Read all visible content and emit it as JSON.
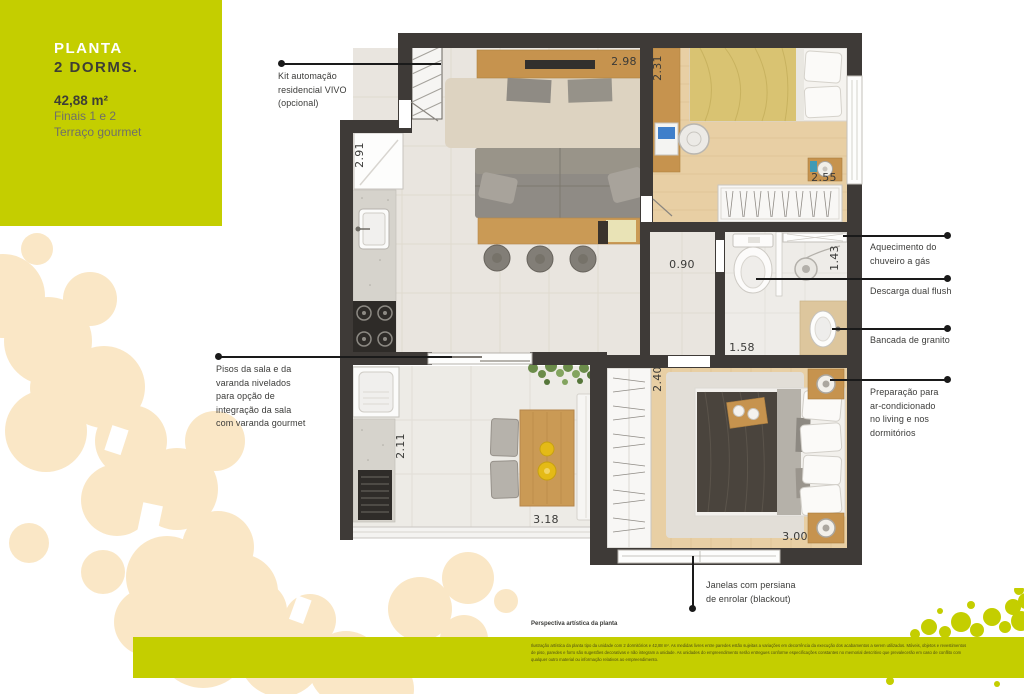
{
  "colors": {
    "accent_green": "#c4ce00",
    "cream_blob": "#fae7c6",
    "wall_dark": "#3e3a37",
    "wood": "#c6934e",
    "text_dark": "#3b3b39",
    "text_gray": "#6f6f68"
  },
  "title_block": {
    "heading_line1": "PLANTA",
    "heading_line2": "2 DORMS.",
    "area": "42,88 m²",
    "subtitle_line1": "Finais 1 e 2",
    "subtitle_line2": "Terraço gourmet"
  },
  "plan": {
    "dims": {
      "living_width": "2.98",
      "dorm1_width": "2.31",
      "kitchen_depth": "2.91",
      "dorm1_wardrobe": "2.55",
      "hall_width": "0.90",
      "shower_depth": "1.43",
      "bath_width": "1.58",
      "dorm2_depth": "2.40",
      "varanda_depth": "2.11",
      "varanda_width": "3.18",
      "dorm2_width": "3.00"
    }
  },
  "callouts": {
    "kit_automacao": "Kit automação\nresidencial VIVO\n(opcional)",
    "pisos": "Pisos da sala e da\nvaranda nivelados\npara opção de\nintegração da sala\ncom varanda gourmet",
    "aquecimento": "Aquecimento do\nchuveiro a gás",
    "descarga": "Descarga dual flush",
    "bancada": "Bancada de granito",
    "preparacao": "Preparação para\nar-condicionado\nno living e nos\ndormitórios",
    "janelas": "Janelas com persiana\nde enrolar (blackout)"
  },
  "footer": {
    "caption": "Perspectiva artística da planta",
    "disclaimer": "Ilustração artística da planta tipo da unidade com 2 dormitórios e 42,88 m². As medidas livres entre paredes estão sujeitas a variações em decorrência da execução dos acabamentos a serem utilizados. Móveis, objetos e revestimentos\nde piso, paredes e forro são sugestões decorativas e não integram a unidade. As unidades do empreendimento serão entregues conforme especificações constantes no memorial descritivo que prevalecerão em caso de conflito com\nqualquer outro material ou informação relativos ao empreendimento."
  }
}
